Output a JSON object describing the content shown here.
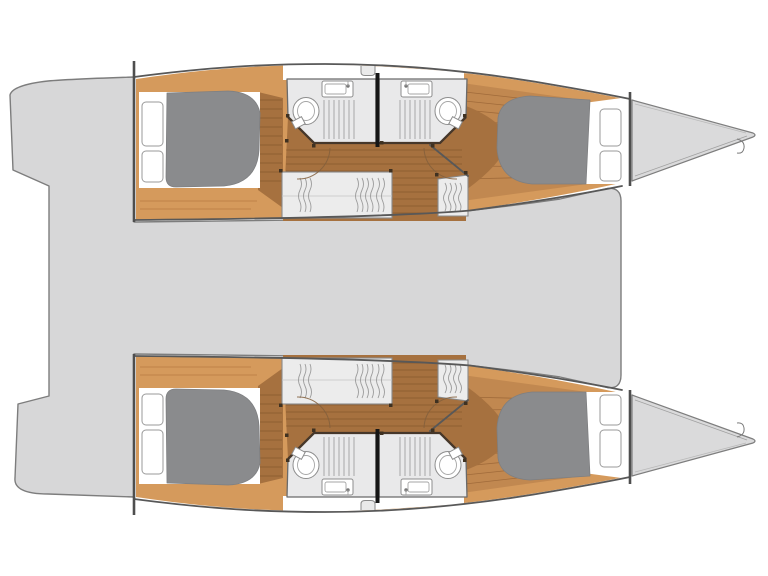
{
  "page": {
    "background": "#ffffff"
  },
  "diagram": {
    "type": "boat-deck-plan",
    "subject": "catamaran-floor-plan-top-view",
    "orientation": {
      "bow": "right",
      "stern": "left"
    },
    "layout_counts": {
      "hulls": 2,
      "cabins": 4,
      "double_berths": 4,
      "bathrooms": 4,
      "toilets": 4,
      "sinks": 4,
      "shower_grates": 4,
      "wardrobes": 4,
      "pillows": 8
    },
    "components": {
      "central": [
        "bridgedeck-saloon-area",
        "aft-cockpit",
        "transom-steps",
        "foredeck-trampoline-area"
      ],
      "per_hull": [
        "aft-double-cabin",
        "forward-double-cabin",
        "aft-bathroom",
        "forward-bathroom",
        "wardrobes",
        "companionway",
        "bow-deck"
      ],
      "fixtures": [
        "toilet",
        "sink",
        "shower-grate",
        "mattress",
        "pillows",
        "wood-floor-planks",
        "door-swing",
        "bulkhead-divider"
      ]
    },
    "colors": {
      "background": "#ffffff",
      "deck": "#d7d7d8",
      "bow_deck": "#dadadb",
      "wood_light": "#d59a5c",
      "wood_mid": "#c18850",
      "wood_dark": "#a6713f",
      "bathroom_floor": "#e9e9ea",
      "wardrobe": "#ececec",
      "mattress": "#8a8b8d",
      "bed_linen": "#ffffff",
      "outline": "#7d7d7d",
      "wall_dark": "#585858",
      "divider": "#161616",
      "fixture_stroke": "#8d8d8d"
    }
  }
}
